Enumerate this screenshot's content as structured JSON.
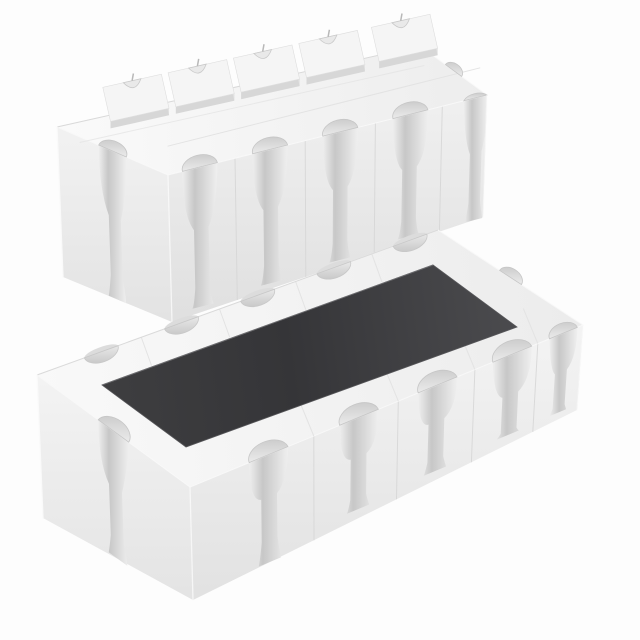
{
  "scene": {
    "type": "product-photo",
    "subject": "Two white ceramic chip resistor-array packages with concave castellated terminals, shown on a plain white background",
    "components": [
      {
        "id": "array-underside",
        "label": "Resistor array package, bottom side facing up",
        "position": "upper-left",
        "visible_features": {
          "raised_terminal_pads_far_edge": 5,
          "castellations_near_edge": 5,
          "castellations_ends": 2,
          "top_marking": "none (plain ceramic underside)"
        }
      },
      {
        "id": "array-topside",
        "label": "Resistor array package, top side facing up",
        "position": "lower-right",
        "visible_features": {
          "dark_resistive_coating_panel": 1,
          "castellations_near_edge": 5,
          "castellations_far_edge": 5,
          "castellations_ends": 2
        }
      }
    ],
    "palette": {
      "background": "#fdfdfd",
      "ceramic_body": "#f2f2f2",
      "face_shadow": "#d9d9d9",
      "groove_shadow": "#c7c7c7",
      "coating_dark": "#3a3a3c",
      "coating_light": "#4b4b4e",
      "edge_highlight": "#ffffff"
    }
  }
}
